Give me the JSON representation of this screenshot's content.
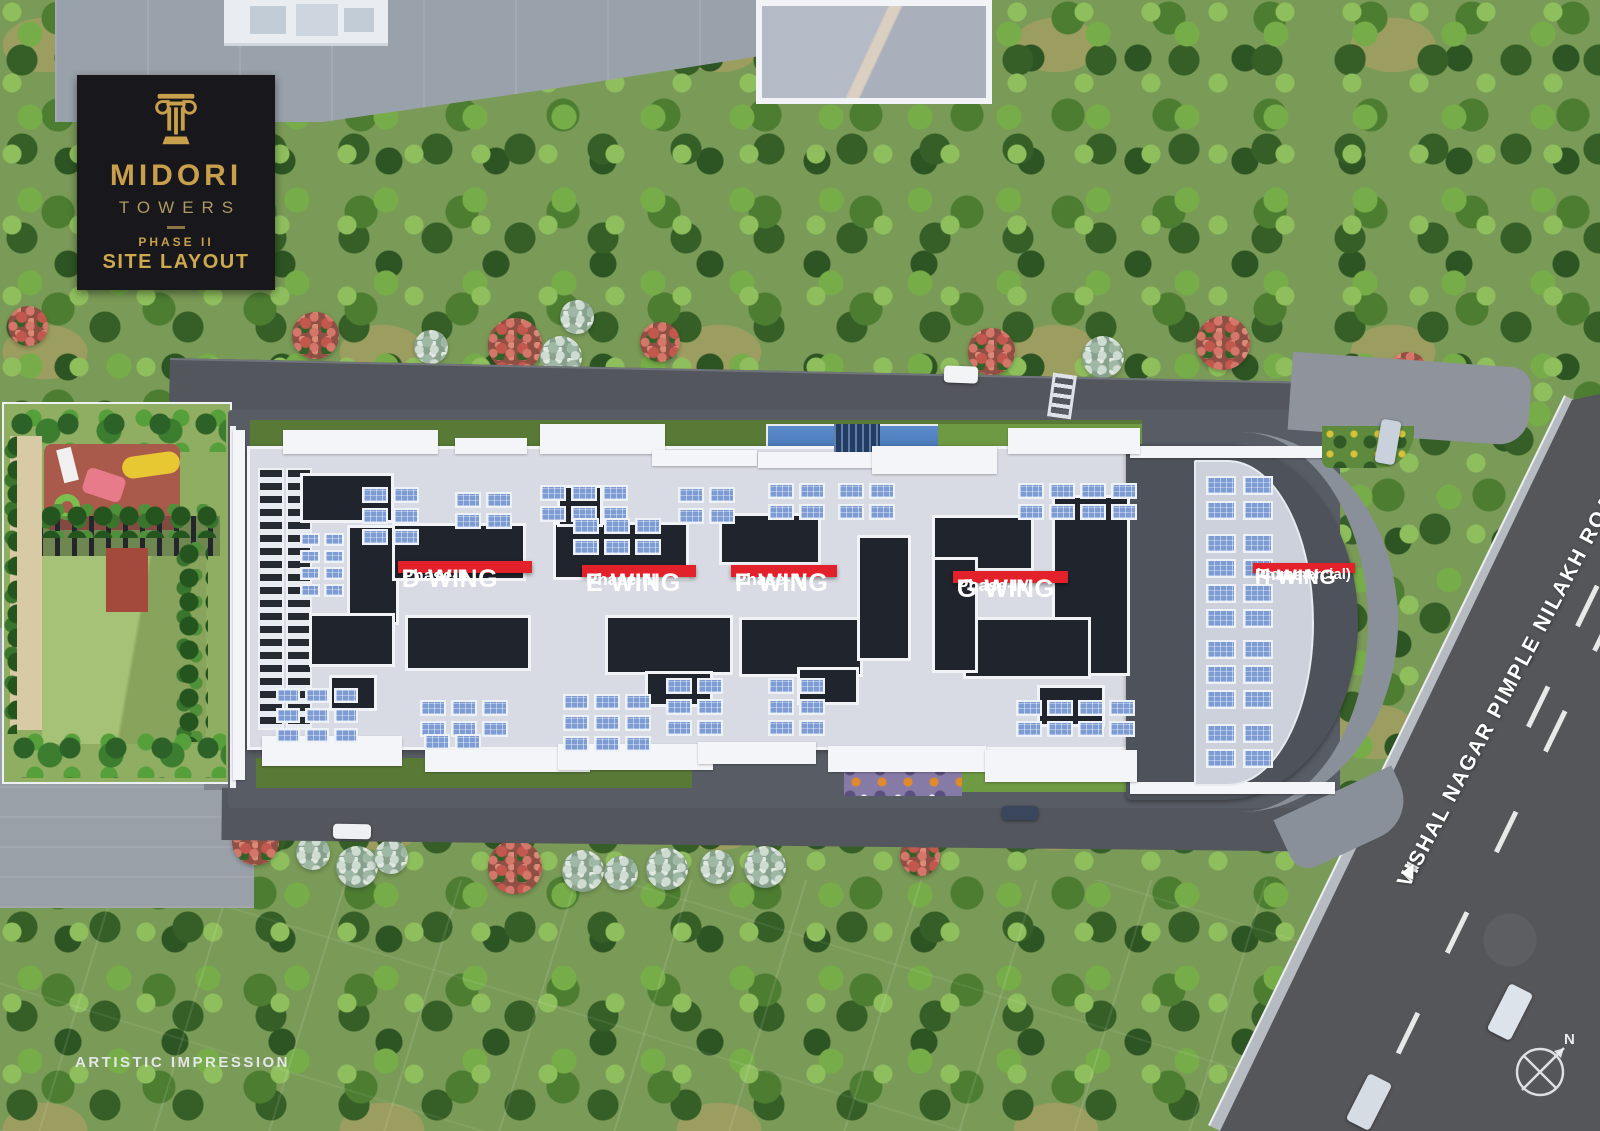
{
  "logo": {
    "brand": "MIDORI",
    "sub": "TOWERS",
    "phase": "PHASE II",
    "caption": "SITE LAYOUT"
  },
  "wings": [
    {
      "name": "D WING",
      "phase": "Phase-II"
    },
    {
      "name": "E WING",
      "phase": "Phase-III"
    },
    {
      "name": "F WING",
      "phase": "Phase-IV"
    },
    {
      "name": "G WING",
      "phase": "Phase-IV"
    },
    {
      "name": "H WING",
      "phase": "Phase-V",
      "note": "(Commercial)"
    }
  ],
  "road": {
    "name": "VISHAL NAGAR PIMPLE NILAKH ROAD",
    "arrow_left": "◀",
    "arrow_right": "▶"
  },
  "compass": {
    "label": "N"
  },
  "footer": {
    "disclaimer": "ARTISTIC IMPRESSION"
  },
  "colors": {
    "accent_gold": "#C89F4A",
    "label_red": "#E2212B",
    "logo_bg": "#17171C",
    "roof_gray": "#D9DBE4",
    "solar_blue": "#7E9CD4"
  }
}
